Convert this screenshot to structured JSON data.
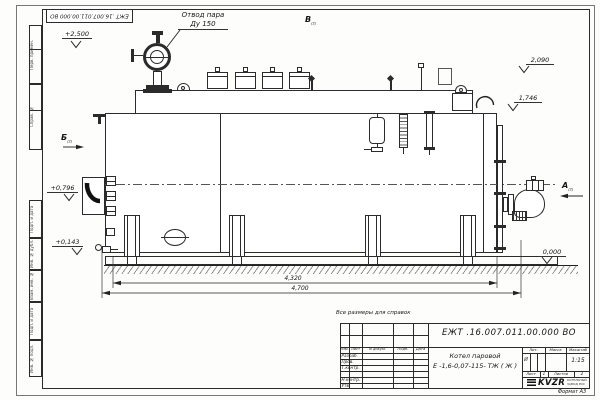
{
  "sheet": {
    "rotated_doc_number": "ЕЖТ .16.007.011.00.000  ВО",
    "reference_note": "Все размеры для справок",
    "format_label": "Формат А3"
  },
  "margin_columns": {
    "perv_primen": "Перв. примен.",
    "sprav_no": "Справ. №",
    "podp_i_data_upper": "Подп. и дата",
    "inv_no_dubl": "Инв. № дубл.",
    "vzam_inv_no": "Взам. инв. №",
    "podp_i_data_lower": "Подп. и дата",
    "inv_no_podl": "Инв. № подл."
  },
  "drawing": {
    "callouts": {
      "steam_outlet": "Отвод пара",
      "steam_outlet_dn": "Ду 150"
    },
    "elevations": {
      "top_valve": "+2,500",
      "drum_top": "2,090",
      "rear_top": "1,746",
      "burner_axis": "+0,796",
      "base": "+0,143",
      "ground": "0,000"
    },
    "dimensions": {
      "boiler_length": "4,320",
      "overall_length": "4,700"
    },
    "view_markers": {
      "b": "Б",
      "v": "В",
      "a": "А",
      "sheet_ref": "(2)"
    }
  },
  "title_block": {
    "doc_number": "ЕЖТ .16.007.011.00.000  ВО",
    "product_name_line1": "Котел паровой",
    "product_name_line2": "Е -1,6-0,07-115- ТЖ ( Ж )",
    "columns": {
      "izm": "Изм.",
      "list": "Лист",
      "docum": "N докум.",
      "podp": "Подп.",
      "data": "Дата"
    },
    "rows": {
      "razrab": "Разраб.",
      "prov": "Пров.",
      "t_kontr": "Т.контр.",
      "n_kontr": "Н.контр.",
      "utv": "Утв."
    },
    "lit_label": "Лит.",
    "lit_value": "И",
    "massa_label": "Масса",
    "masshtab_label": "Масштаб",
    "scale_value": "1:15",
    "sheet_label": "Лист",
    "sheet_value": "1",
    "sheets_label": "Листов",
    "sheets_value": "2",
    "logo_text": "KVZR",
    "logo_caption_line1": "КОТЕЛЬНЫЙ",
    "logo_caption_line2": "ЗАВОД РОС"
  }
}
